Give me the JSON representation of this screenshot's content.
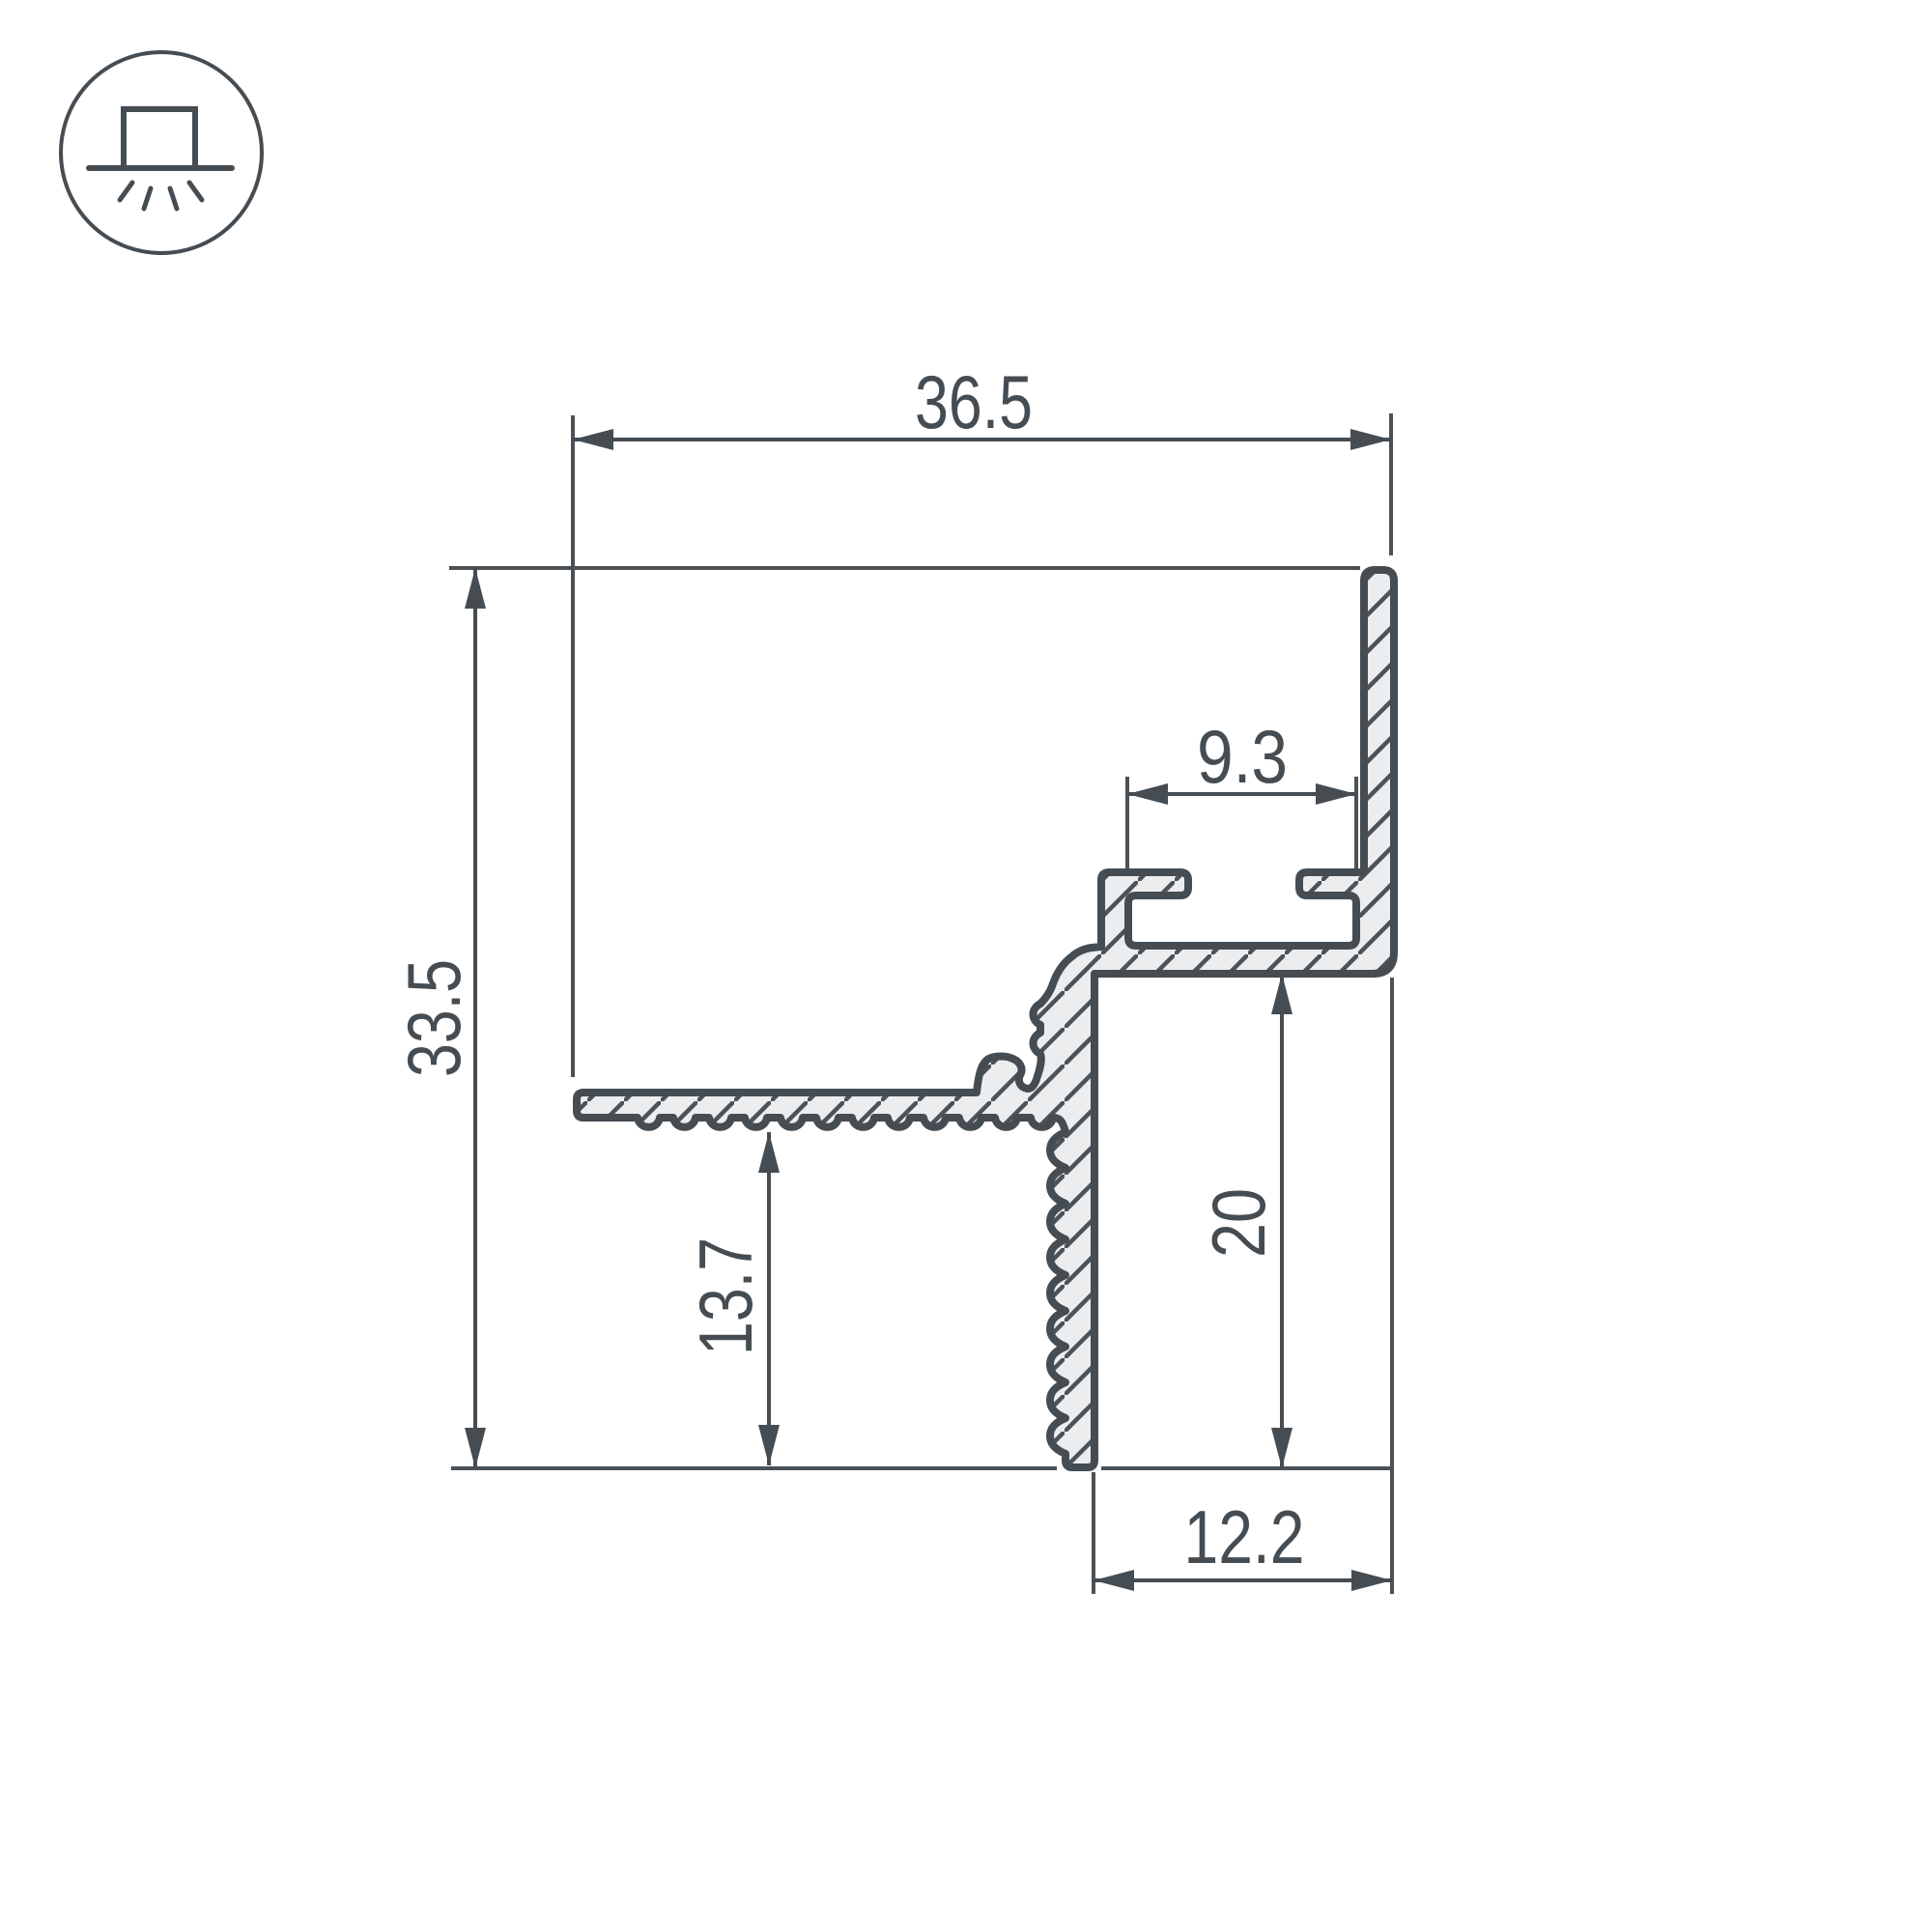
{
  "drawing": {
    "kind": "led-profile-cross-section",
    "icon": {
      "name": "recessed-mount-light-icon"
    },
    "colors": {
      "ink": "#454d53",
      "metal_fill": "#ecedee",
      "background": "#ffffff"
    },
    "dimensions": {
      "overall_width": "36.5",
      "overall_height": "33.5",
      "slot_width": "9.3",
      "wall_depth": "20",
      "flange_depth": "13.7",
      "bottom_width": "12.2"
    }
  }
}
